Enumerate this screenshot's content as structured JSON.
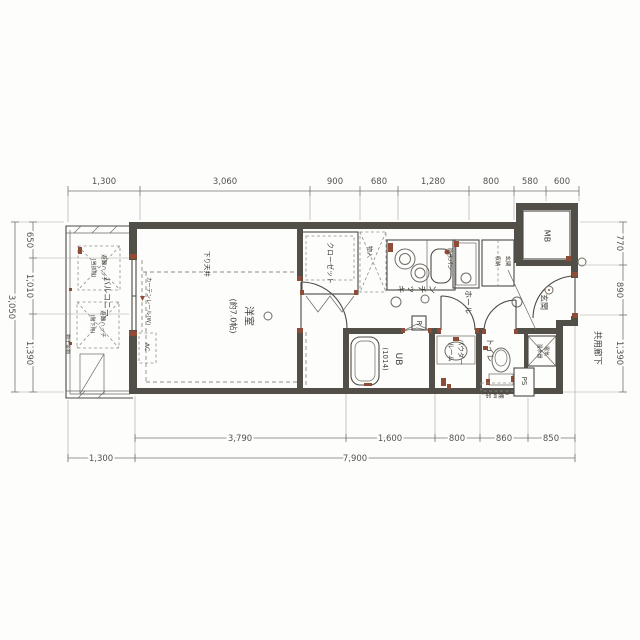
{
  "rooms": {
    "living": {
      "name": "洋室",
      "size": "(約7.0帖)"
    },
    "balcony": "バルコニー",
    "kitchen": "キッチン",
    "closet": "クローゼット",
    "storage": "物入",
    "hall": "ホール",
    "entrance": "玄関",
    "entrance_storage": {
      "line1": "玄関",
      "line2": "収納"
    },
    "toilet": "トイレ",
    "powder": {
      "line1": "パウダー",
      "line2": "ルーム"
    },
    "unit_bath": {
      "line1": "UB",
      "line2": "(1014)"
    },
    "corridor": "共用廊下",
    "meter_box": "MB",
    "pipe_space": "PS"
  },
  "fixtures": {
    "waterproof_pan": "防水パン",
    "water_heater": {
      "line1": "電気",
      "line2": "温水器"
    },
    "refrigerator": "R",
    "ac": "AC",
    "hanging_cupboard": "(吊戸棚)"
  },
  "annotations": {
    "lowered_ceiling": "下り天井",
    "curtain_rail": "カーテンレール(W)",
    "evac_hatch_upper": {
      "line1": "避難ハッチ",
      "line2": "(当該階)"
    },
    "evac_hatch_lower": {
      "line1": "避難ハッチ",
      "line2": "(階下用)"
    },
    "laundry_hardware": "物干金物"
  },
  "dimensions": {
    "top": [
      "1,300",
      "3,060",
      "900",
      "680",
      "1,280",
      "800",
      "580",
      "600"
    ],
    "bottom_detail": [
      "3,790",
      "1,600",
      "800",
      "860",
      "850"
    ],
    "bottom_overall": [
      "1,300",
      "7,900"
    ],
    "left": [
      "650",
      "1,010",
      "1,390"
    ],
    "left_total": "3,050",
    "right": [
      "770",
      "890",
      "1,390"
    ]
  },
  "colors": {
    "wall": "#524f49",
    "line": "#4c4a45",
    "accent": "#8e4c38",
    "dimension_text": "#55534e",
    "paper": "#fdfdfb"
  }
}
